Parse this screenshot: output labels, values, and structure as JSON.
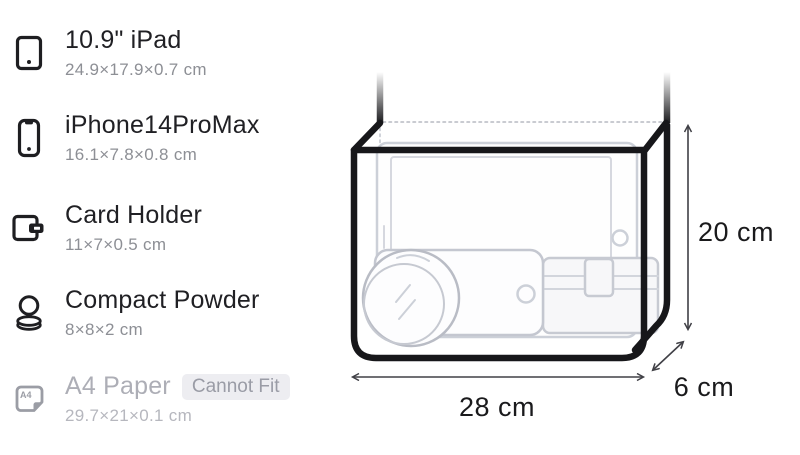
{
  "sidebar": {
    "items": [
      {
        "icon": "tablet-icon",
        "name": "10.9\" iPad",
        "dims": "24.9×17.9×0.7 cm",
        "fits": true
      },
      {
        "icon": "smartphone-icon",
        "name": "iPhone14ProMax",
        "dims": "16.1×7.8×0.8 cm",
        "fits": true
      },
      {
        "icon": "wallet-icon",
        "name": "Card Holder",
        "dims": "11×7×0.5 cm",
        "fits": true
      },
      {
        "icon": "compact-powder-icon",
        "name": "Compact Powder",
        "dims": "8×8×2 cm",
        "fits": true
      },
      {
        "icon": "a4-paper-icon",
        "name": "A4 Paper",
        "dims": "29.7×21×0.1 cm",
        "fits": false,
        "badge": "Cannot Fit",
        "icon_label": "A4"
      }
    ]
  },
  "bag_diagram": {
    "width_label": "28 cm",
    "height_label": "20 cm",
    "depth_label": "6 cm",
    "contents_shown": [
      "iPad",
      "iPhone",
      "Card Holder",
      "Compact Powder"
    ]
  },
  "colors": {
    "text_primary": "#202024",
    "text_secondary": "#8d8f95",
    "disabled_text": "#adaeb6",
    "badge_bg": "#ededf1",
    "badge_text": "#9a9ca6",
    "bag_outline": "#17171a",
    "ghost_items": "#c7cad2",
    "arrow": "#404046"
  }
}
